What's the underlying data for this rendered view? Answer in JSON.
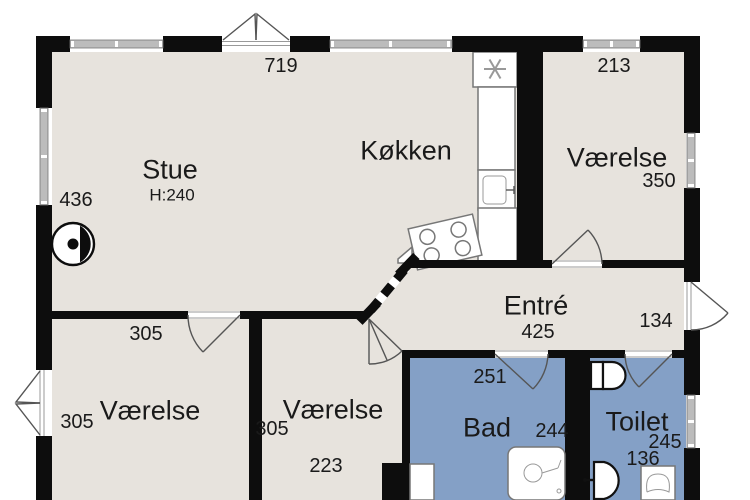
{
  "floor_plan": {
    "rooms": {
      "stue": {
        "name": "Stue",
        "ceiling_height": "H:240"
      },
      "kokken": {
        "name": "Køkken"
      },
      "vaerelse_ne": {
        "name": "Værelse"
      },
      "entre": {
        "name": "Entré"
      },
      "vaerelse_sw": {
        "name": "Værelse"
      },
      "vaerelse_s": {
        "name": "Værelse"
      },
      "bad": {
        "name": "Bad"
      },
      "toilet": {
        "name": "Toilet"
      }
    },
    "dimensions": {
      "top_width": "719",
      "ne_room_width": "213",
      "ne_room_depth": "350",
      "west_wall_height": "436",
      "entre_width": "425",
      "entre_depth": "134",
      "sw_room_width": "305",
      "sw_room_depth": "305",
      "s_room_depth": "305",
      "s_room_width": "223",
      "bad_width": "251",
      "bad_depth": "244",
      "toilet_depth": "245",
      "toilet_width": "136"
    },
    "colors": {
      "floor": "#e7e3dd",
      "wet_room_floor": "#84a0c6",
      "wall": "#0d0d0d",
      "window_band": "#bcbcbc"
    }
  }
}
